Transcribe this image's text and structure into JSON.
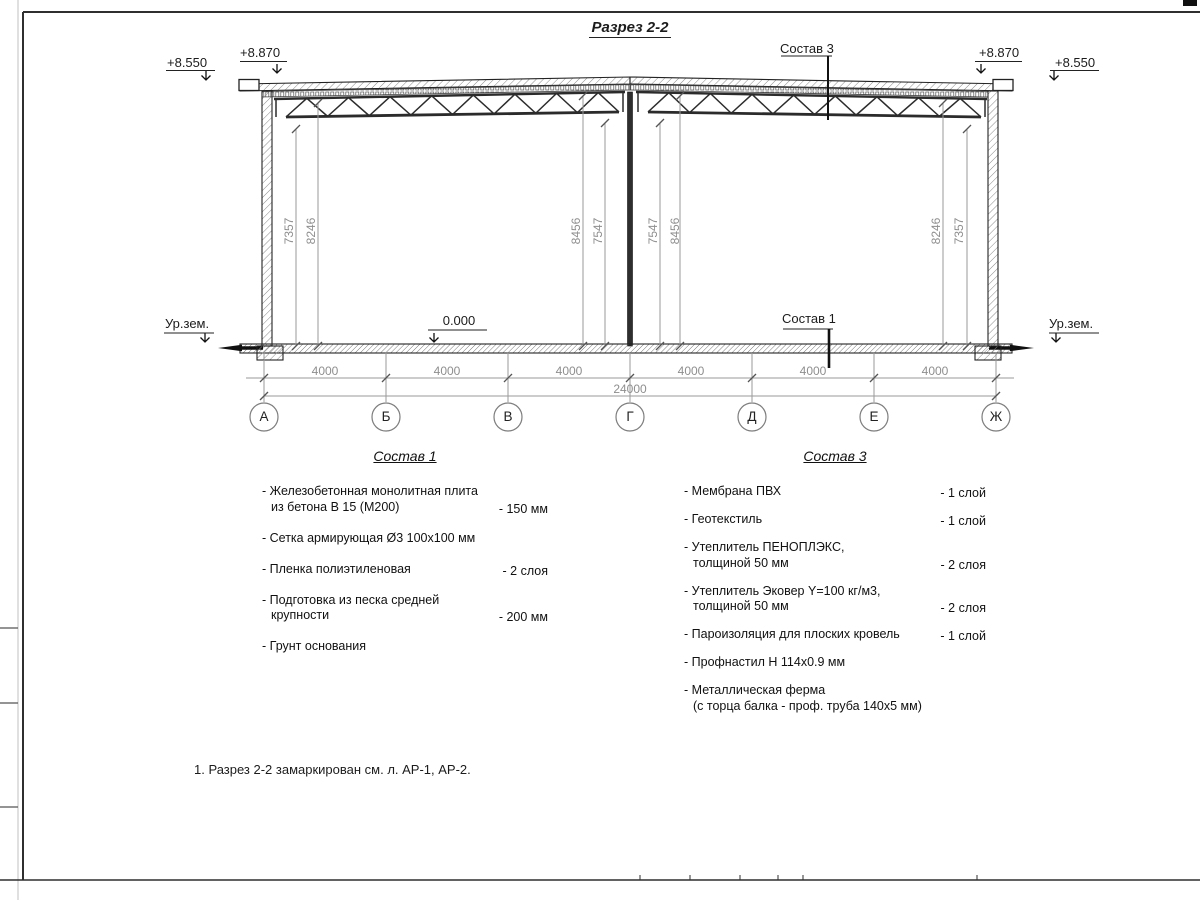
{
  "title": "Разрез 2-2",
  "drawing": {
    "elev_left_outer": "+8.550",
    "elev_left_inner": "+8.870",
    "elev_right_inner": "+8.870",
    "elev_right_outer": "+8.550",
    "ground_left": "Ур.зем.",
    "ground_right": "Ур.зем.",
    "zero_level": "0.000",
    "callout_roof": "Состав 3",
    "callout_floor": "Состав 1",
    "vdims": {
      "left": [
        "7357",
        "8246"
      ],
      "center_left": [
        "8456",
        "7547"
      ],
      "center_right": [
        "7547",
        "8456"
      ],
      "right": [
        "8246",
        "7357"
      ]
    },
    "spans": [
      "4000",
      "4000",
      "4000",
      "4000",
      "4000",
      "4000"
    ],
    "total": "24000",
    "axes": [
      "А",
      "Б",
      "В",
      "Г",
      "Д",
      "Е",
      "Ж"
    ]
  },
  "legend1": {
    "title": "Состав 1",
    "items": [
      {
        "text": "- Железобетонная  монолитная плита\nиз бетона В 15 (М200)",
        "value": "- 150 мм"
      },
      {
        "text": "- Сетка армирующая Ø3 100х100 мм",
        "value": ""
      },
      {
        "text": "- Пленка полиэтиленовая",
        "value": "- 2 слоя"
      },
      {
        "text": "- Подготовка из песка средней\nкрупности",
        "value": "- 200 мм"
      },
      {
        "text": "- Грунт основания",
        "value": ""
      }
    ]
  },
  "legend3": {
    "title": "Состав 3",
    "items": [
      {
        "text": "- Мембрана ПВХ",
        "value": "- 1 слой"
      },
      {
        "text": "- Геотекстиль",
        "value": "- 1 слой"
      },
      {
        "text": "- Утеплитель ПЕНОПЛЭКС,\nтолщиной 50 мм",
        "value": "- 2 слоя"
      },
      {
        "text": "- Утеплитель Эковер Y=100 кг/м3,\nтолщиной 50 мм",
        "value": "- 2 слоя"
      },
      {
        "text": "- Пароизоляция для плоских кровель",
        "value": "- 1 слой"
      },
      {
        "text": "- Профнастил Н 114х0.9 мм",
        "value": ""
      },
      {
        "text": "- Металлическая ферма\n(с торца балка - проф. труба 140х5 мм)",
        "value": ""
      }
    ]
  },
  "note": "1. Разрез 2-2 замаркирован см. л. АР-1, АР-2."
}
